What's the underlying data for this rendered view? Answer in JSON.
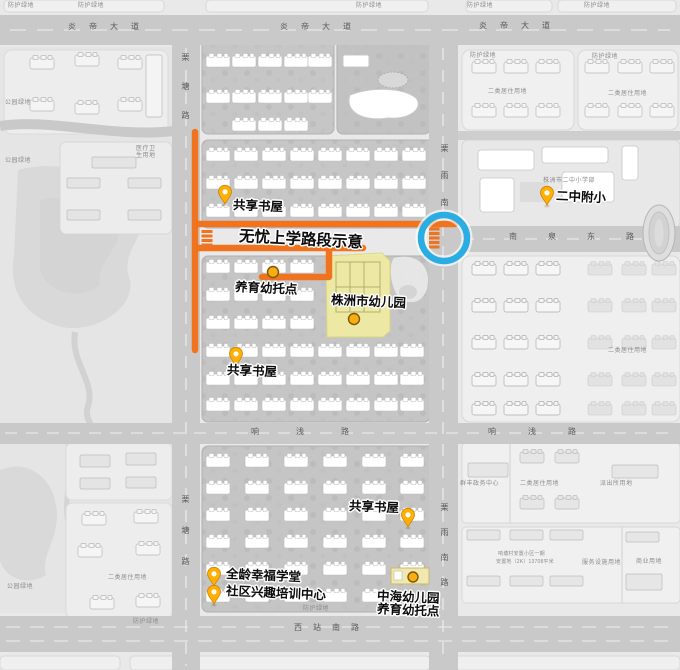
{
  "colors": {
    "route_orange": "#f0741f",
    "pin_gold": "#ffb003",
    "pin_stroke": "#c8830a",
    "poi_orange": "#f9ac14",
    "highlight_yellow": "#f2eea2",
    "highlight_yellow_stroke": "#ddd67e",
    "ring_blue": "#2aade3"
  },
  "icons": {
    "location_pin": "map-pin",
    "poi_marker": "orange-dot",
    "crossing_highlight": "blue-ring",
    "crosswalk": "orange-striped-zebra"
  },
  "roads": {
    "yandi_avenue": "炎帝大道",
    "litang_road": "栗塘路",
    "liyu_south_road_short": "栗雨南",
    "liyu_south_road": "栗雨南路",
    "nanquan_east_road": "南泉东路",
    "xiangqian_road": "响浅路",
    "xizhan_south_road": "西站南路"
  },
  "annotations": {
    "route_title": "无忧上学路段示意",
    "shared_book_house": "共享书屋",
    "nursery_care_point": "养育幼托点",
    "zhuzhou_city_kindergarten": "株洲市幼儿园",
    "erzhong_affiliated_primary": "二中附小",
    "all_age_happiness_school": "全龄幸福学堂",
    "community_interest_training_center": "社区兴趣培训中心",
    "zhonghai_kindergarten_line1": "中海幼儿园",
    "zhonghai_kindergarten_line2": "养育幼托点"
  },
  "parcels": {
    "protective_green": "防护绿地",
    "park_green": "公园绿地",
    "class2_residential": "二类居住用地",
    "medical_line1": "医疗卫",
    "medical_line2": "生用地",
    "police_station": "派出所用地",
    "qunfeng_admin_center": "群丰政务中心",
    "service_facilities": "服务设施用地",
    "commercial": "商业用地",
    "resettlement_line1": "响塘村安置小区一期",
    "resettlement_line2": "安置地（2K）13708平米",
    "erzhong_primary_campus": "株洲市二中小学部"
  }
}
